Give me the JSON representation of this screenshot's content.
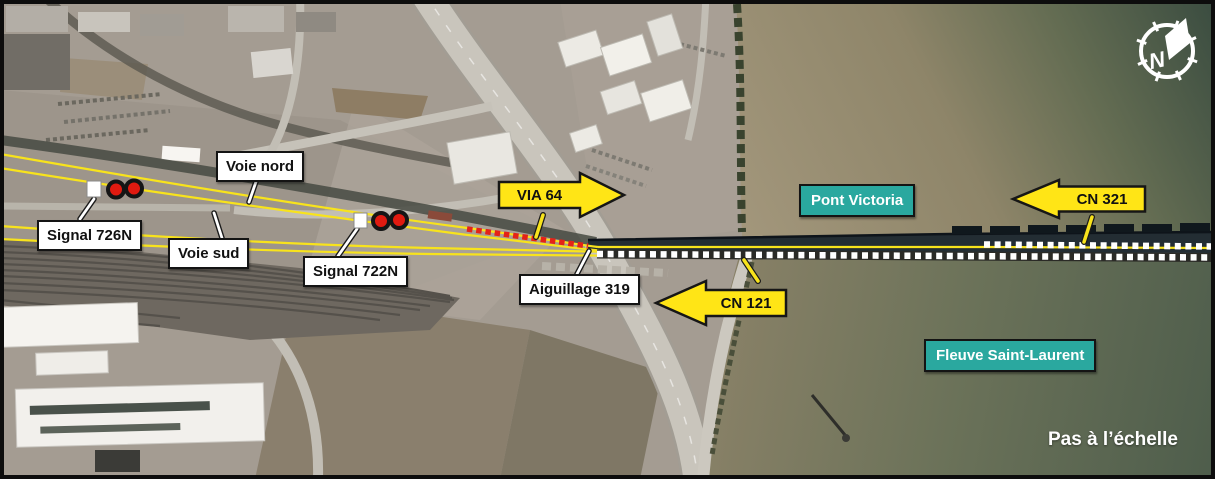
{
  "figure": {
    "type": "annotated-aerial-map",
    "scale_note": "Pas à l’échelle",
    "compass_letter": "N"
  },
  "track_labels": {
    "voie_nord": "Voie nord",
    "voie_sud": "Voie sud"
  },
  "infrastructure_labels": {
    "signal_726n": "Signal 726N",
    "signal_722n": "Signal 722N",
    "aiguillage_319": "Aiguillage 319"
  },
  "place_labels": {
    "pont_victoria": "Pont Victoria",
    "fleuve_saint_laurent": "Fleuve Saint-Laurent"
  },
  "train_arrows": {
    "via_64": {
      "label": "VIA 64",
      "direction": "right"
    },
    "cn_321": {
      "label": "CN 321",
      "direction": "left"
    },
    "cn_121": {
      "label": "CN 121",
      "direction": "left"
    }
  },
  "colors": {
    "track_yellow": "#f8e31c",
    "via_route_red": "#e42318",
    "cn_route_white": "#ffffff",
    "teal_label": "#2aa89f",
    "arrow_yellow": "#ffe516"
  }
}
